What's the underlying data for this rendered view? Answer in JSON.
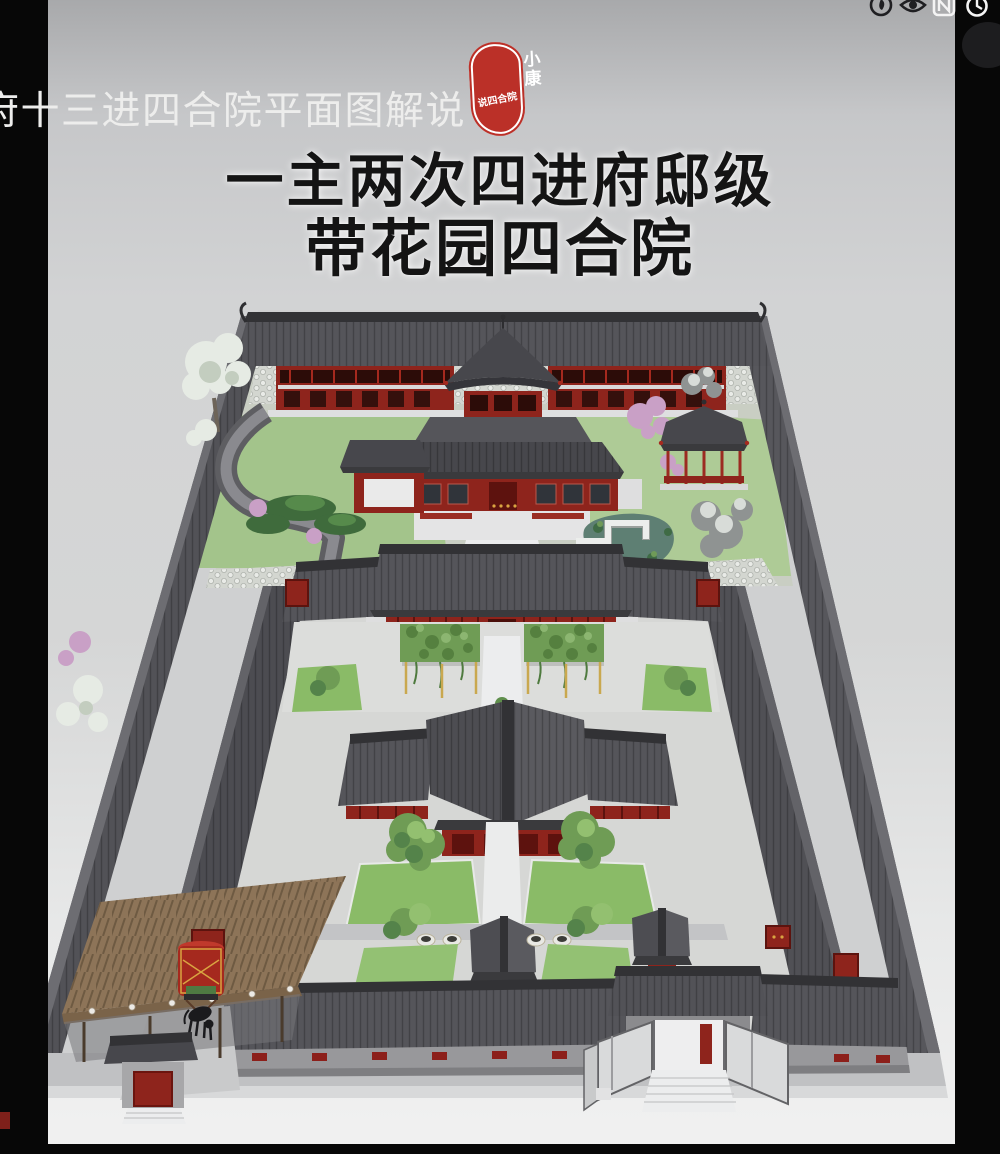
{
  "status_bar": {
    "icons": [
      "record-circle-icon",
      "eye-protect-icon",
      "floating-window-icon",
      "alarm-clock-icon"
    ]
  },
  "caption": {
    "text": "府十三进四合院平面图解说"
  },
  "seal": {
    "top": "小康",
    "bottom": "说四合院"
  },
  "title": {
    "line1": "一主两次四进府邸级",
    "line2": "带花园四合院"
  },
  "scene": {
    "description": "3D bird's-eye model of a four-courtyard siheyuan mansion with rear garden, pavilions, winding corridor, pond, main gate, side gate, horse carriage and shed"
  },
  "colors": {
    "bg_top": "#a8a9ab",
    "bg_mid": "#d2d3d4",
    "bg_bottom": "#f1f1f1",
    "bar_black": "#070707",
    "caption_color": "#ededec",
    "title_color": "#141414",
    "seal_red": "#bb3028",
    "roof_dark": "#55555a",
    "roof_ridge": "#323235",
    "facade_red": "#8e241c",
    "accent_red": "#a5291e",
    "lawn_green": "#8abb67",
    "garden_green": "#a3c48b",
    "tree_green": "#6f9c55",
    "blossom_pink": "#c9a0c6",
    "snow_white": "#e6ebe4",
    "pond_green": "#5e7f73",
    "wood_brown": "#8d7458",
    "gold": "#d9a441"
  }
}
